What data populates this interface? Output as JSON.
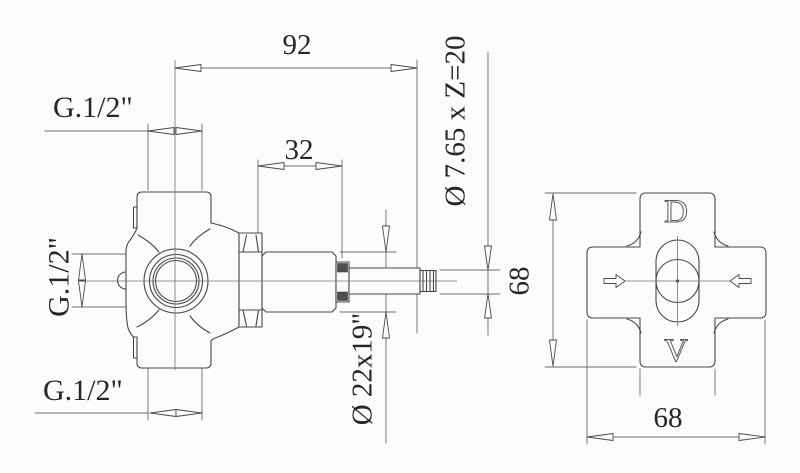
{
  "front_view": {
    "dim_overall_length": "92",
    "dim_cartridge_length": "32",
    "thread_top_label": "G.1/2\"",
    "thread_side_label": "G.1/2\"",
    "thread_bottom_label": "G.1/2\"",
    "spline_spec_label": "Ø 7.65 x Z=20",
    "cartridge_spec_label": "Ø 22x19\""
  },
  "plate_view": {
    "dim_height": "68",
    "dim_width": "68",
    "marking_top": "D",
    "marking_bottom": "V"
  },
  "colors": {
    "line": "#474747",
    "text": "#262626",
    "background": "#fcfcfc"
  }
}
